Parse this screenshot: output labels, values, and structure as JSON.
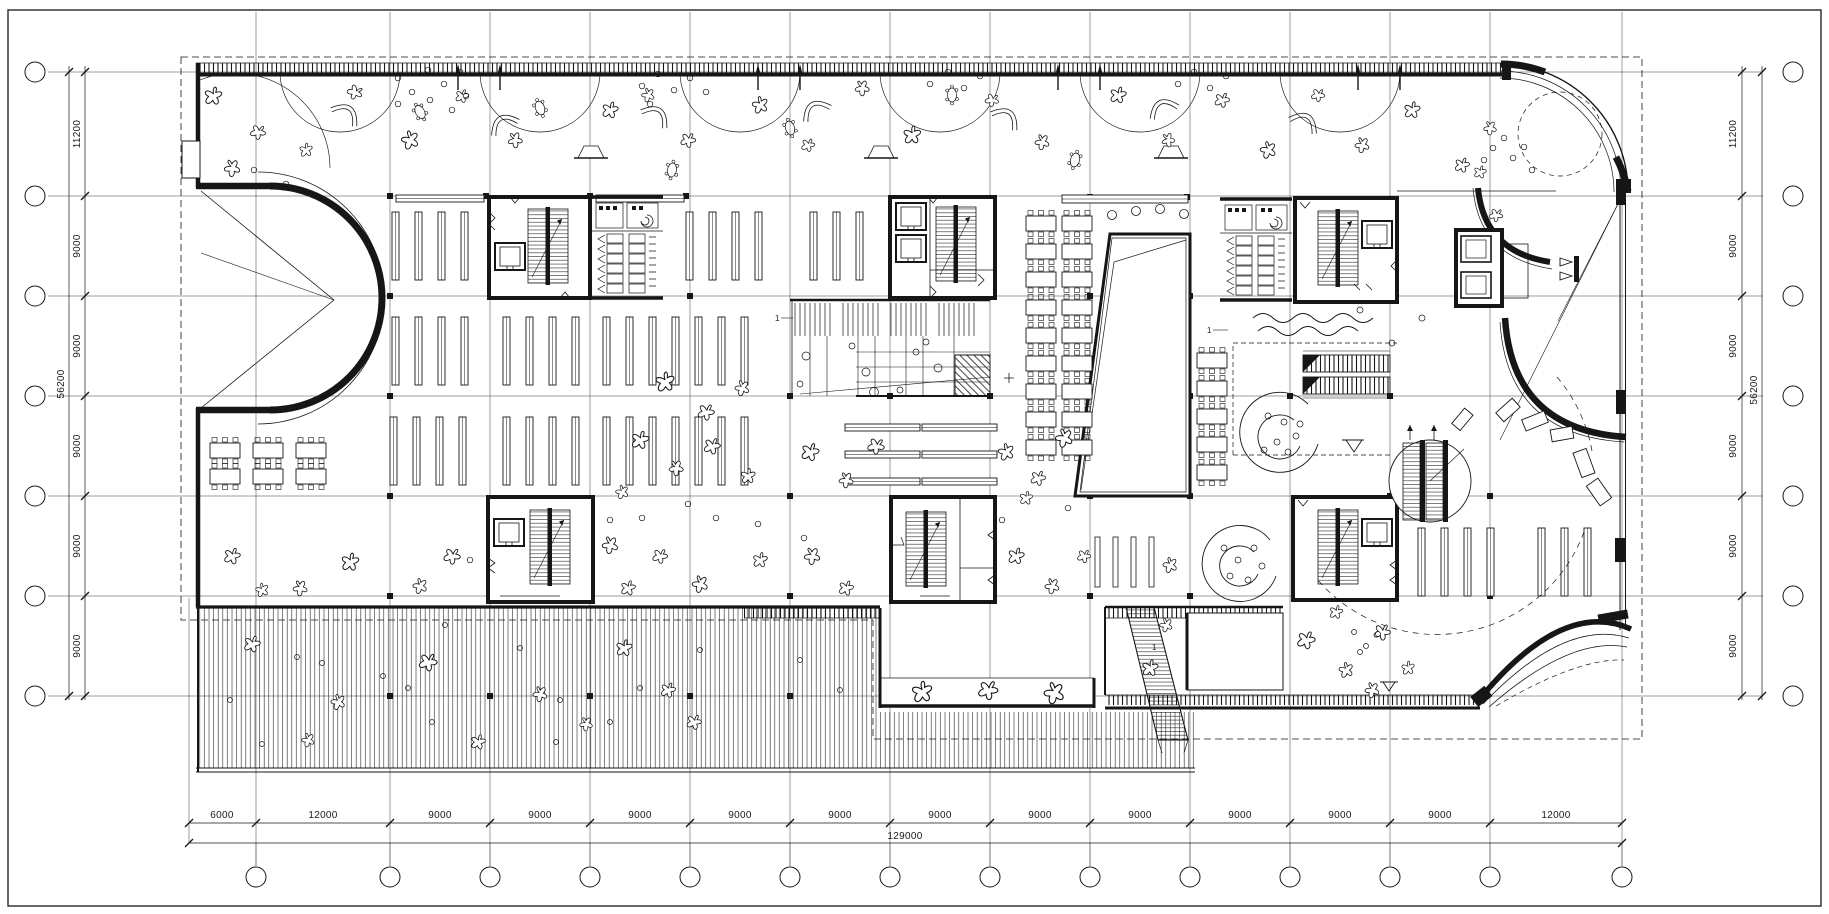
{
  "drawing": {
    "type": "architectural-floor-plan",
    "dims": {
      "bottom": {
        "segments": [
          "6000",
          "12000",
          "9000",
          "9000",
          "9000",
          "9000",
          "9000",
          "9000",
          "9000",
          "9000",
          "9000",
          "9000",
          "9000",
          "12000"
        ],
        "total": "129000"
      },
      "left": {
        "segments": [
          "11200",
          "9000",
          "9000",
          "9000",
          "9000",
          "9000"
        ],
        "total": "56200"
      },
      "right": {
        "segments": [
          "11200",
          "9000",
          "9000",
          "9000",
          "9000",
          "9000"
        ],
        "total": "56200"
      }
    },
    "tags": {
      "stair_sections": [
        "1",
        "1",
        "1"
      ]
    },
    "colors": {
      "ink": "#161616",
      "paper": "#ffffff"
    }
  }
}
